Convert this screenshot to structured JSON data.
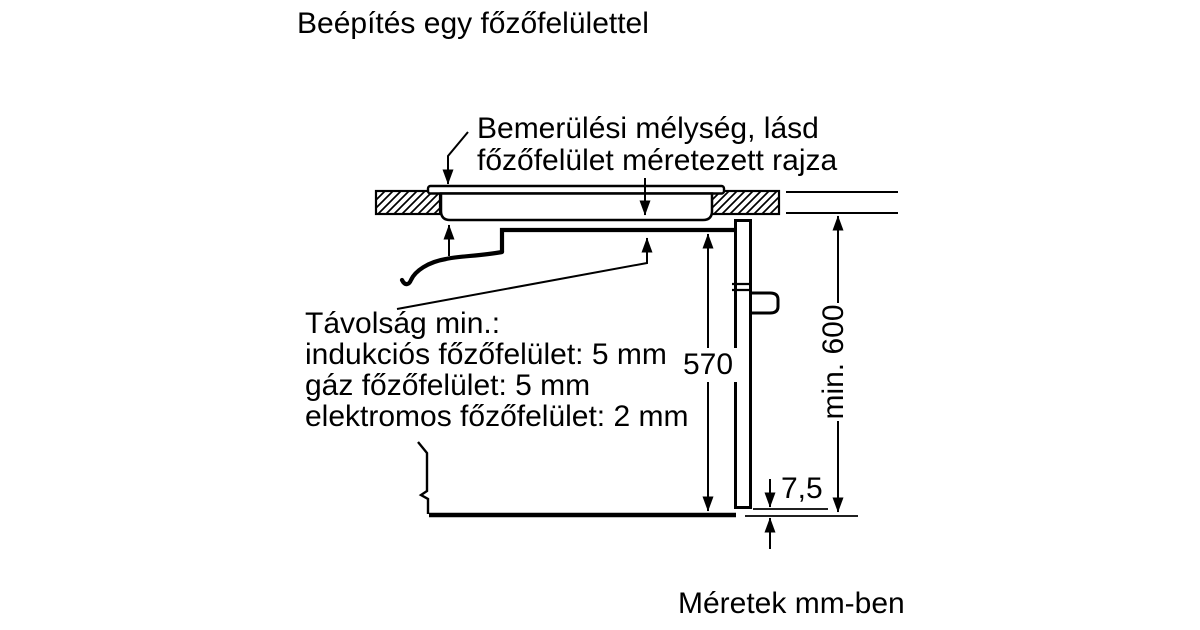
{
  "title": "Beépítés egy főzőfelülettel",
  "callout_immersion": {
    "line1": "Bemerülési mélység, lásd",
    "line2": "főzőfelület méretezett rajza"
  },
  "note_min_distance": {
    "heading": "Távolság min.:",
    "induction": "indukciós főzőfelület: 5 mm",
    "gas": "gáz főzőfelület: 5 mm",
    "electric": "elektromos főzőfelület: 2 mm"
  },
  "dimensions": {
    "oven_height_mm": "570",
    "niche_height_mm": "min. 600",
    "door_gap_mm": "7,5"
  },
  "footer_units_note": "Méretek mm-ben",
  "colors": {
    "ink": "#000000",
    "paper": "#ffffff"
  }
}
